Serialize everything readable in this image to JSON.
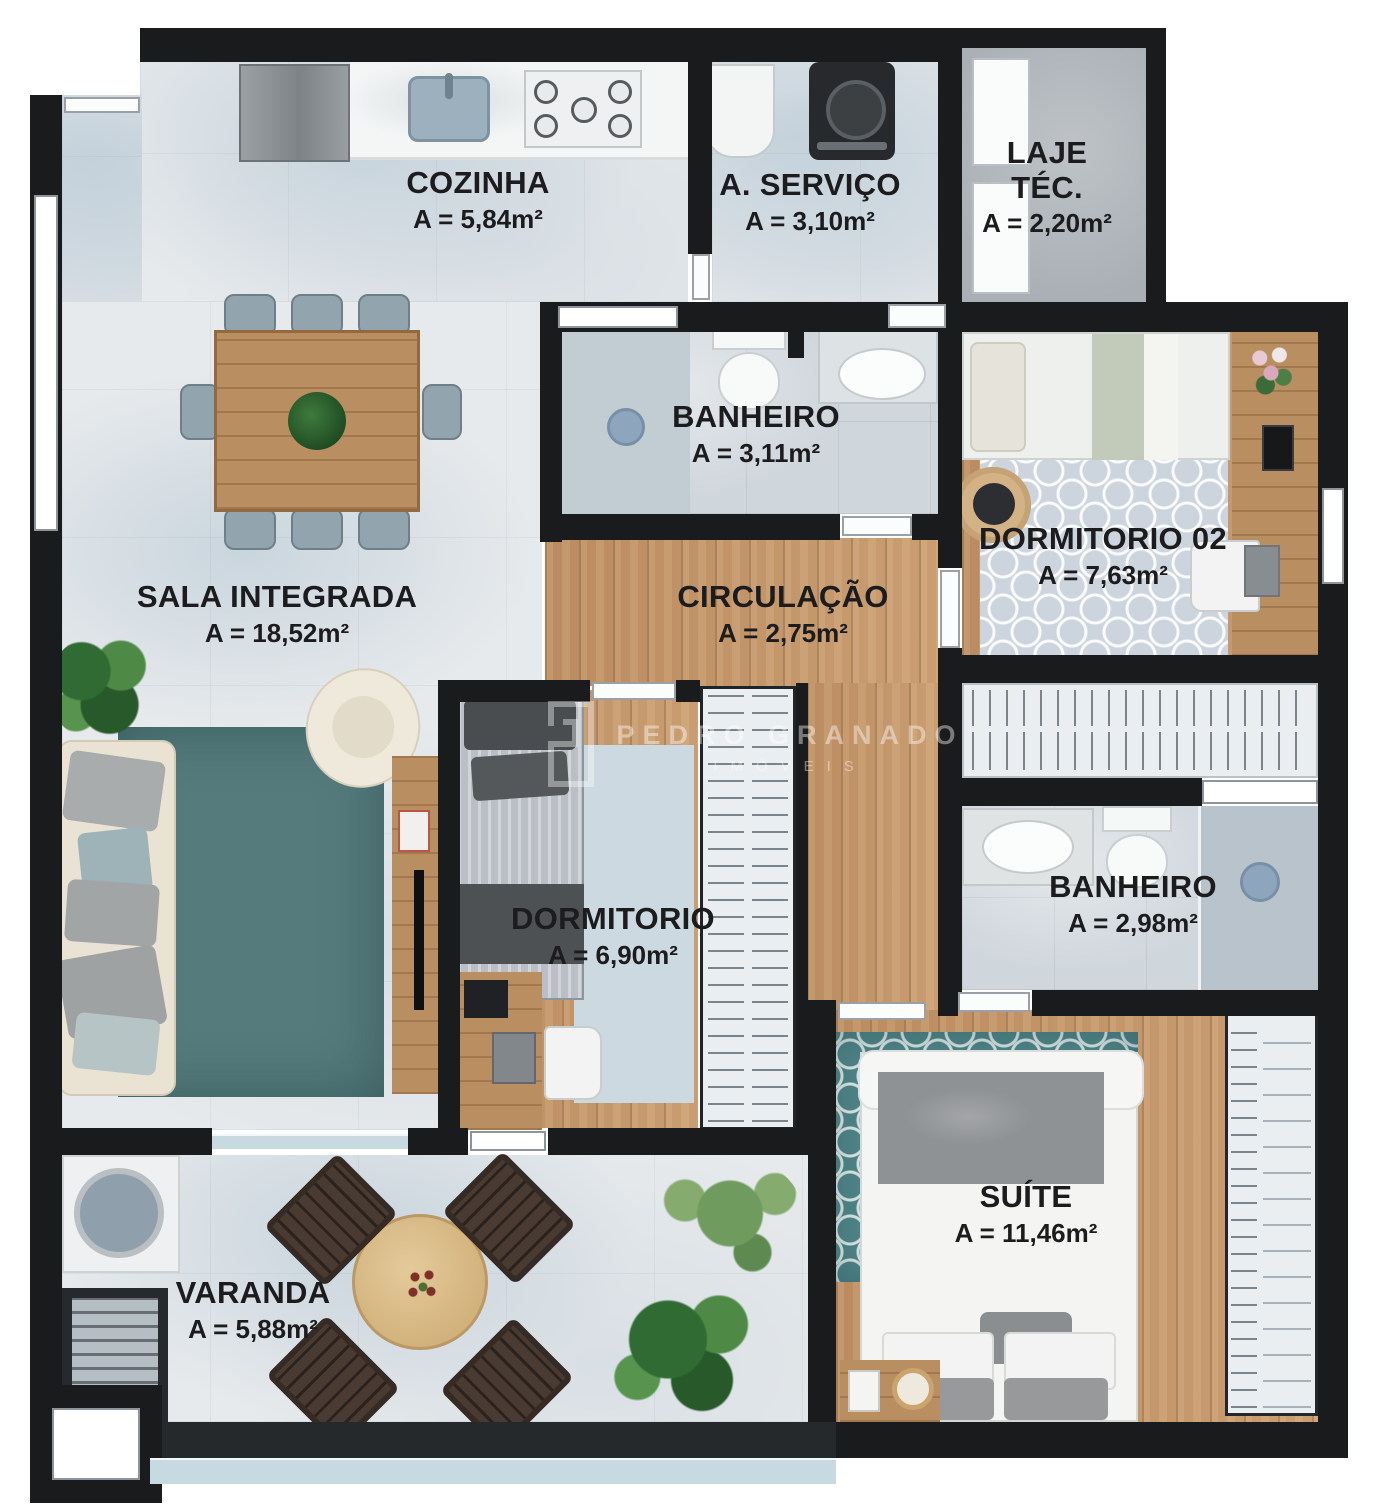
{
  "watermark": {
    "brand": "PEDRO GRANADO",
    "subtitle": "IMÓVEIS"
  },
  "rooms": {
    "cozinha": {
      "name": "COZINHA",
      "area": "A = 5,84m²"
    },
    "servico": {
      "name": "A. SERVIÇO",
      "area": "A = 3,10m²"
    },
    "laje_tec": {
      "name": "LAJE TÉC.",
      "area": "A = 2,20m²"
    },
    "banheiro_social": {
      "name": "BANHEIRO",
      "area": "A = 3,11m²"
    },
    "dormitorio_02": {
      "name": "DORMITORIO 02",
      "area": "A = 7,63m²"
    },
    "sala": {
      "name": "SALA INTEGRADA",
      "area": "A = 18,52m²"
    },
    "circulacao": {
      "name": "CIRCULAÇÃO",
      "area": "A = 2,75m²"
    },
    "dormitorio": {
      "name": "DORMITORIO",
      "area": "A = 6,90m²"
    },
    "banheiro_suite": {
      "name": "BANHEIRO",
      "area": "A = 2,98m²"
    },
    "suite": {
      "name": "SUÍTE",
      "area": "A = 11,46m²"
    },
    "varanda": {
      "name": "VARANDA",
      "area": "A = 5,88m²"
    }
  },
  "colors": {
    "wall": "#1a1b1d",
    "wood_floor": "#c49468",
    "tile_floor": "#e7eaec",
    "bath_tile": "#cfd6dc",
    "living_rug": "#557b7d",
    "suite_rug": "#4f8387"
  }
}
